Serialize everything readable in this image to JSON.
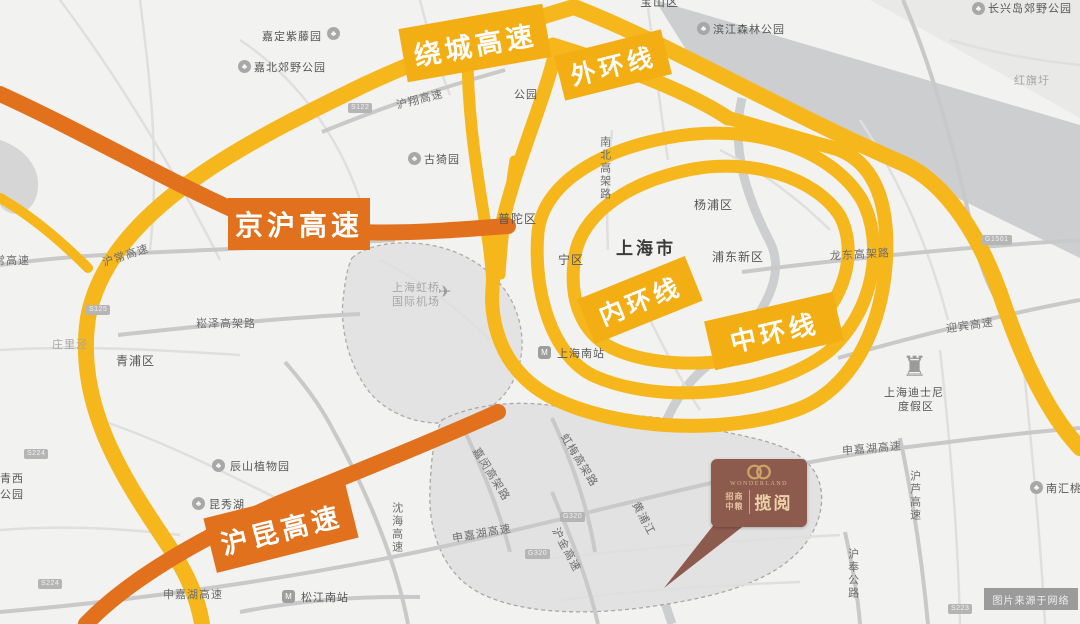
{
  "colors": {
    "highway_yellow": "#f6b71c",
    "highway_orange": "#e2711d",
    "banner_yellow": "#f3ae14",
    "banner_orange": "#e8761e",
    "marker_brown": "#8d5b4e",
    "marker_gold": "#cfa368",
    "water_gray": "#cdced0"
  },
  "icons": {
    "park": "♣",
    "station": "M",
    "plane": "✈",
    "castle": "♜"
  },
  "banners": [
    {
      "text": "绕城高速",
      "type": "yellow"
    },
    {
      "text": "外环线",
      "type": "yellow"
    },
    {
      "text": "京沪高速",
      "type": "orange"
    },
    {
      "text": "内环线",
      "type": "yellow"
    },
    {
      "text": "中环线",
      "type": "yellow"
    },
    {
      "text": "沪昆高速",
      "type": "orange"
    }
  ],
  "labels": [
    {
      "text": "宝山区"
    },
    {
      "text": "嘉定紫藤园"
    },
    {
      "text": "嘉北郊野公园"
    },
    {
      "text": "滨江森林公园"
    },
    {
      "text": "长兴岛郊野公园"
    },
    {
      "text": "红旗圩"
    },
    {
      "text": "沪翔高速"
    },
    {
      "text": "公园"
    },
    {
      "text": "古猗园"
    },
    {
      "text": "普陀区"
    },
    {
      "text": "南北高架路"
    },
    {
      "text": "杨浦区"
    },
    {
      "text": "上海市"
    },
    {
      "text": "浦东新区"
    },
    {
      "text": "宁区"
    },
    {
      "text": "龙东高架路"
    },
    {
      "text": "迎宾高速"
    },
    {
      "text": "上海迪士尼"
    },
    {
      "text": "度假区"
    },
    {
      "text": "上海虹桥"
    },
    {
      "text": "国际机场"
    },
    {
      "text": "崧泽高架路"
    },
    {
      "text": "沪常高速"
    },
    {
      "text": "常高速"
    },
    {
      "text": "庄里泾"
    },
    {
      "text": "青浦区"
    },
    {
      "text": "辰山植物园"
    },
    {
      "text": "昆秀湖"
    },
    {
      "text": "沈海高速"
    },
    {
      "text": "松江南站"
    },
    {
      "text": "申嘉湖高速"
    },
    {
      "text": "嘉闵高架路"
    },
    {
      "text": "虹梅高架路"
    },
    {
      "text": "申嘉湖高速"
    },
    {
      "text": "沪金高速"
    },
    {
      "text": "黄浦江"
    },
    {
      "text": "申嘉湖高速"
    },
    {
      "text": "沪芦高速"
    },
    {
      "text": "南汇桃花村"
    },
    {
      "text": "沪奉公路"
    },
    {
      "text": "青西"
    },
    {
      "text": "公园"
    },
    {
      "text": "上海南站"
    }
  ],
  "shields": [
    "S122",
    "S125",
    "S224",
    "S224",
    "G320",
    "G320",
    "G1501",
    "S223"
  ],
  "marker": {
    "logo_brand": "WONDERLAND",
    "company_line1": "招商",
    "company_line2": "中粮",
    "project_name": "揽阅"
  },
  "watermark": "图片来源于网络"
}
